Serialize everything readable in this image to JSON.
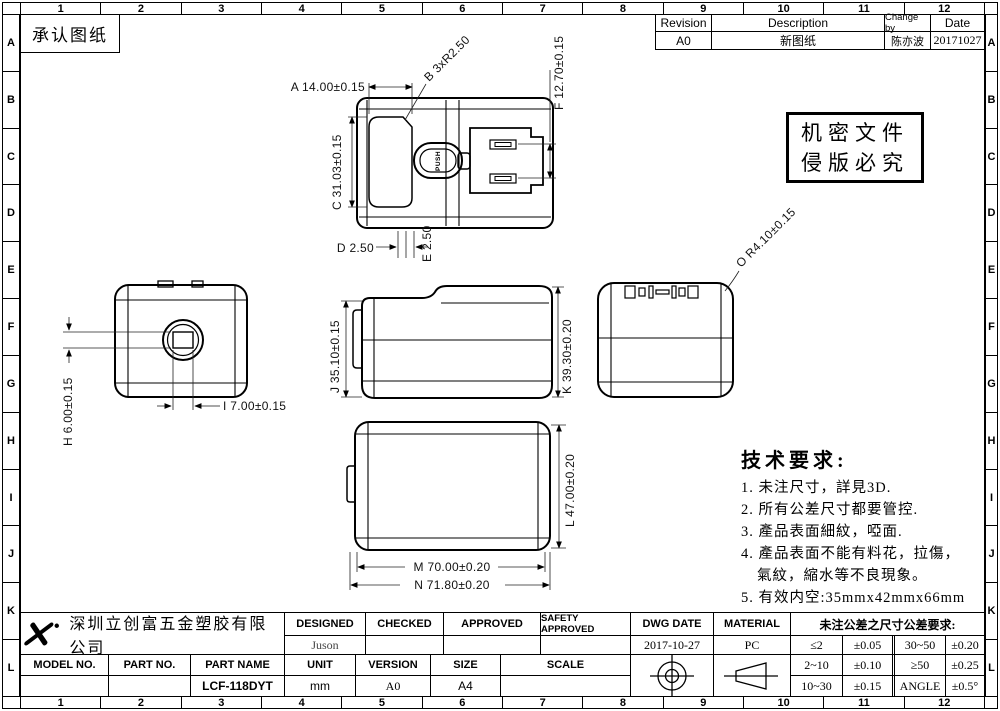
{
  "header": {
    "approval_title": "承认图纸"
  },
  "border": {
    "cols": [
      "1",
      "2",
      "3",
      "4",
      "5",
      "6",
      "7",
      "8",
      "9",
      "10",
      "11",
      "12"
    ],
    "rows": [
      "A",
      "B",
      "C",
      "D",
      "E",
      "F",
      "G",
      "H",
      "I",
      "J",
      "K",
      "L"
    ]
  },
  "revision": {
    "headers": {
      "revision": "Revision",
      "description": "Description",
      "change_by": "Change by",
      "date": "Date"
    },
    "row": {
      "revision": "A0",
      "description": "新图纸",
      "change_by": "陈亦波",
      "date": "20171027"
    }
  },
  "confidential": {
    "line1": "机密文件",
    "line2": "侵版必究"
  },
  "tech": {
    "title": "技术要求:",
    "lines": [
      "1. 未注尺寸，詳見3D.",
      "2. 所有公差尺寸都要管控.",
      "3. 產品表面細紋，啞面.",
      "4. 產品表面不能有料花，拉傷，",
      "氣紋，縮水等不良現象。",
      "5. 有效内空:35mmx42mmx66mm"
    ]
  },
  "dims": {
    "a": "A 14.00±0.15",
    "b": "B 3xR2.50",
    "c": "C 31.03±0.15",
    "d": "D 2.50",
    "e": "E 2.50",
    "f": "F 12.70±0.15",
    "h": "H 6.00±0.15",
    "i": "I 7.00±0.15",
    "j": "J 35.10±0.15",
    "k": "K 39.30±0.20",
    "l": "L 47.00±0.20",
    "m": "M 70.00±0.20",
    "n": "N 71.80±0.20",
    "o": "O R4.10±0.15",
    "push": "PUSH"
  },
  "title_block": {
    "company": "深圳立创富五金塑胶有限公司",
    "designed": {
      "label": "DESIGNED",
      "value": "Juson"
    },
    "checked": {
      "label": "CHECKED",
      "value": ""
    },
    "approved": {
      "label": "APPROVED",
      "value": ""
    },
    "safety": {
      "label": "SAFETY APPROVED",
      "value": ""
    },
    "dwg_date": {
      "label": "DWG  DATE",
      "value": "2017-10-27"
    },
    "model_no": {
      "label": "MODEL NO.",
      "value": ""
    },
    "part_no": {
      "label": "PART NO.",
      "value": ""
    },
    "part_name": {
      "label": "PART NAME",
      "value": "LCF-118DYT"
    },
    "unit": {
      "label": "UNIT",
      "value": "mm"
    },
    "version": {
      "label": "VERSION",
      "value": "A0"
    },
    "size": {
      "label": "SIZE",
      "value": "A4"
    },
    "scale": {
      "label": "SCALE",
      "value": ""
    },
    "material": {
      "label": "MATERIAL",
      "value": "PC"
    },
    "tolerance_title": "未注公差之尺寸公差要求:",
    "tolerances": [
      {
        "range": "≤2",
        "tol": "±0.05"
      },
      {
        "range": "2~10",
        "tol": "±0.10"
      },
      {
        "range": "10~30",
        "tol": "±0.15"
      },
      {
        "range": "30~50",
        "tol": "±0.20"
      },
      {
        "range": "≥50",
        "tol": "±0.25"
      },
      {
        "range": "ANGLE",
        "tol": "±0.5°"
      }
    ]
  }
}
